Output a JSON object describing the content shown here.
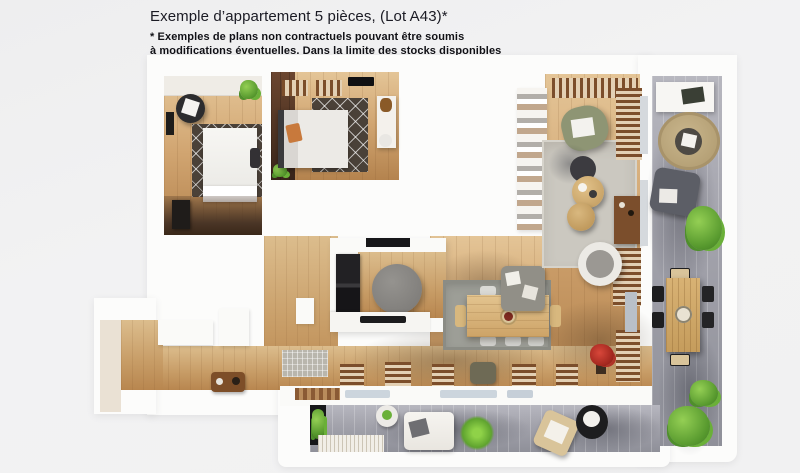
{
  "header": {
    "title": "Exemple d’appartement 5 pièces, (Lot A43)*",
    "disclaimer_line1": "* Exemples de plans non contractuels pouvant être soumis",
    "disclaimer_line2": "à modifications éventuelles. Dans la limite des stocks disponibles"
  },
  "palette": {
    "page_background": "#f1f1f2",
    "text_dark": "#1b1b24",
    "plan_wall_white": "#fcfcfb",
    "wood_light": "#e4c597",
    "wood_mid": "#c79c66",
    "wood_walnut": "#4e3322",
    "terrace_deck_grey": "#a2a2ab",
    "living_rug_grey": "#cbc8c0",
    "dining_rug_grey": "#9d9e97",
    "bedroom_rug_dark": "#4a4138",
    "round_rug_beige": "#c0ac83",
    "plant_green": "#6ab038",
    "armchair_olive": "#8e9574",
    "pillow_orange": "#c8793c",
    "flower_red": "#c03328",
    "table_wood": "#dcbd84",
    "appliance_black": "#1a1a1c",
    "console_brown": "#7d4e28",
    "window_glass": "#ccd5dd"
  }
}
